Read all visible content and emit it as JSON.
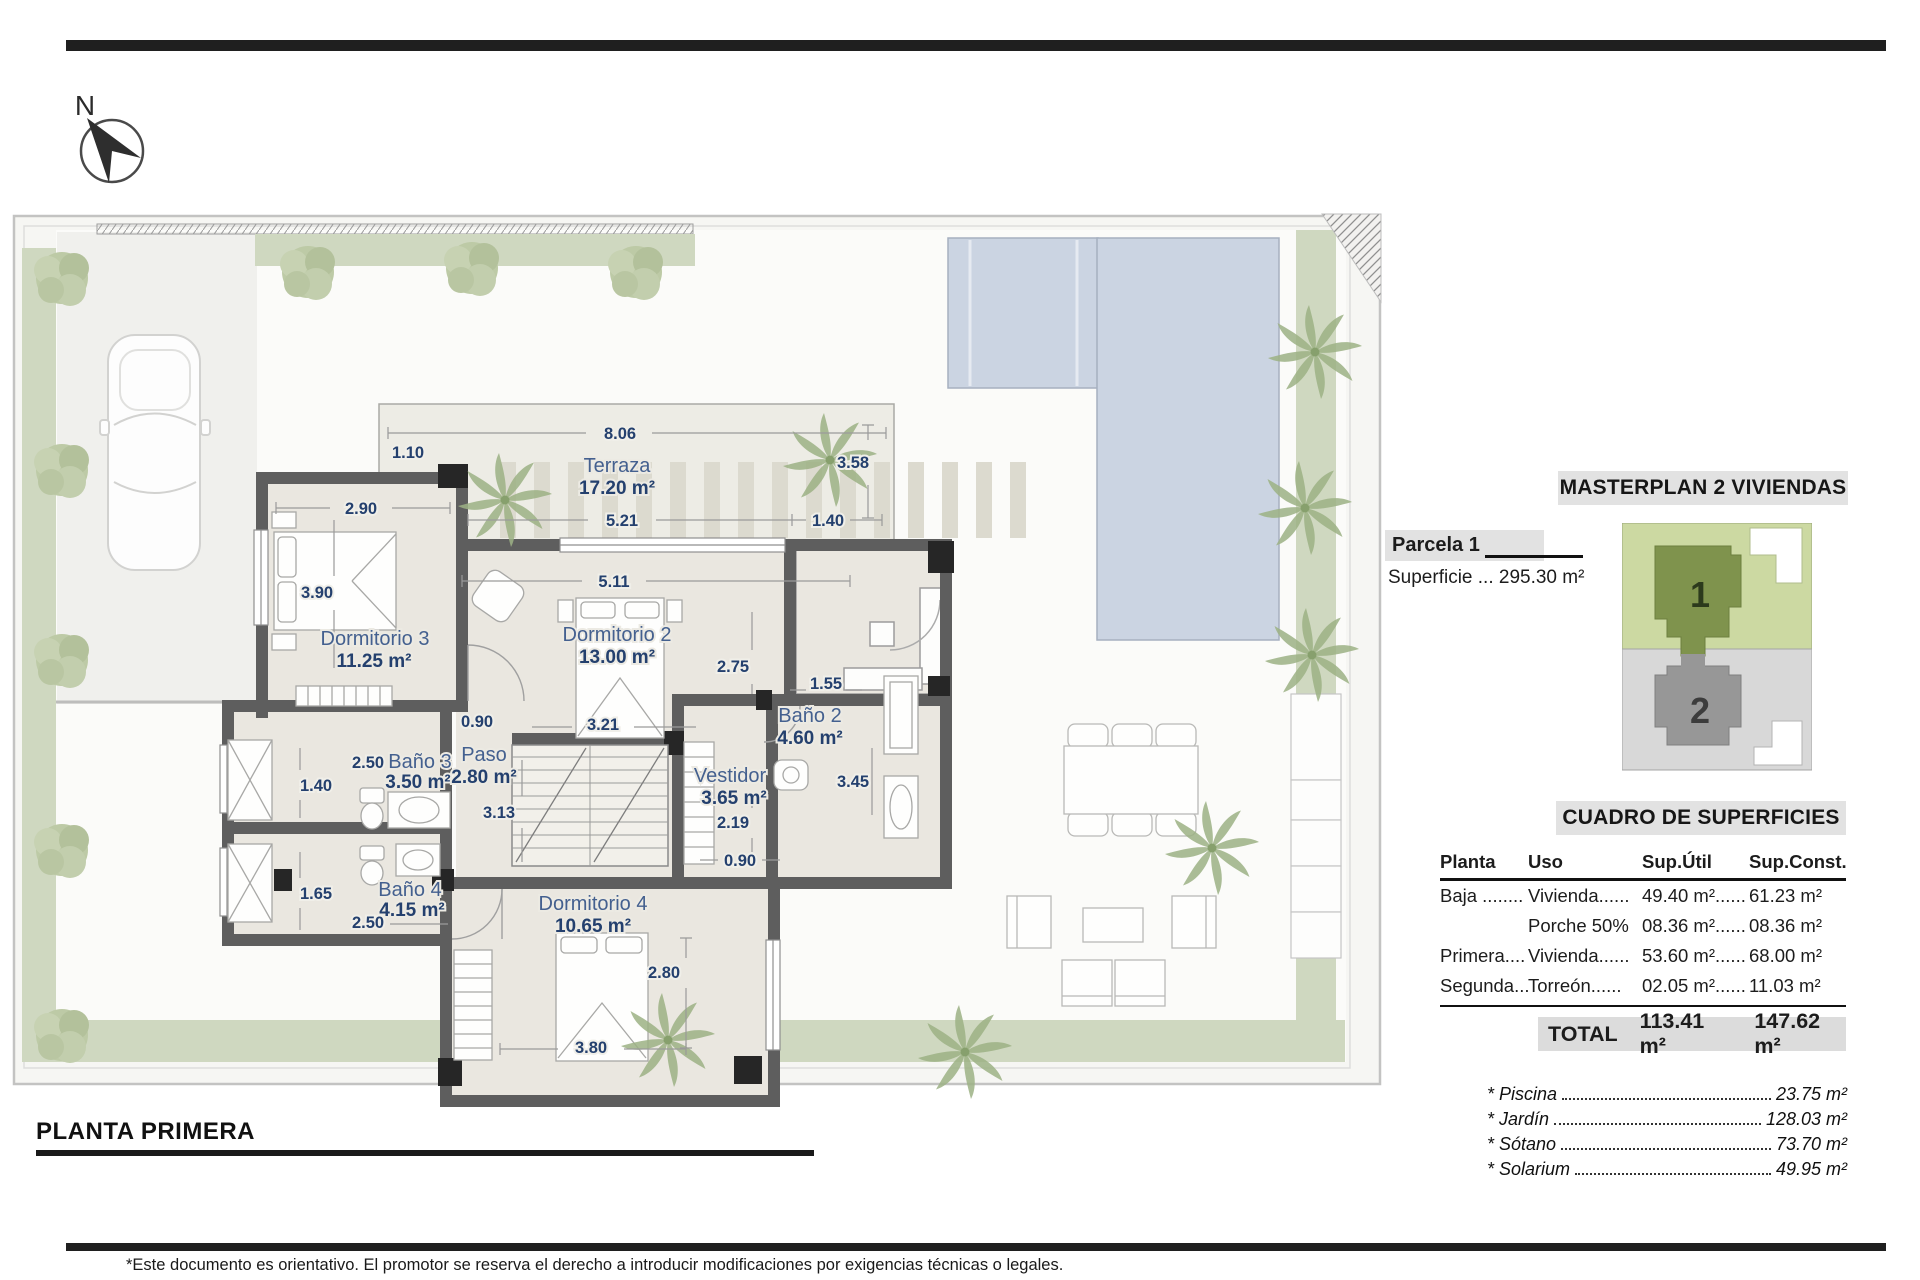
{
  "page": {
    "north_label": "N",
    "plan_title": "PLANTA PRIMERA",
    "disclaimer": "*Este documento es orientativo. El promotor se reserva el derecho a introducir modificaciones por exigencias técnicas o legales."
  },
  "plan": {
    "rooms": {
      "terraza": {
        "name": "Terraza",
        "area": "17.20 m²"
      },
      "dormitorio3": {
        "name": "Dormitorio 3",
        "area": "11.25 m²"
      },
      "dormitorio2": {
        "name": "Dormitorio 2",
        "area": "13.00 m²"
      },
      "bano2": {
        "name": "Baño 2",
        "area": "4.60 m²"
      },
      "bano3": {
        "name": "Baño 3",
        "area": "3.50 m²"
      },
      "bano4": {
        "name": "Baño 4",
        "area": "4.15 m²"
      },
      "paso": {
        "name": "Paso",
        "area": "2.80 m²"
      },
      "vestidor": {
        "name": "Vestidor",
        "area": "3.65 m²"
      },
      "dormitorio4": {
        "name": "Dormitorio 4",
        "area": "10.65 m²"
      }
    },
    "dims": {
      "terraza_width": "8.06",
      "terraza_left": "1.10",
      "terraza_right": "3.58",
      "dorm3_width": "2.90",
      "terraza_inner": "5.21",
      "terraza_gap": "1.40",
      "dorm2_width": "5.11",
      "dorm3_height": "3.90",
      "dorm2_height": "2.75",
      "bano2_width": "1.55",
      "paso_width": "0.90",
      "bed2_width": "3.21",
      "paso_height": "3.13",
      "vestidor_height": "2.19",
      "vestidor_width": "0.90",
      "bano2_height": "3.45",
      "bano3_width": "2.50",
      "bano3_height": "1.40",
      "bano4_height": "1.65",
      "bano4_width": "2.50",
      "dorm4_height": "2.80",
      "dorm4_width": "3.80"
    }
  },
  "masterplan": {
    "title": "MASTERPLAN 2 VIVIENDAS",
    "parcela": "Parcela 1",
    "superficie": "Superficie ... 295.30 m²",
    "unit1": "1",
    "unit2": "2"
  },
  "cuadro": {
    "title": "CUADRO DE SUPERFICIES",
    "headers": {
      "planta": "Planta",
      "uso": "Uso",
      "util": "Sup.Útil",
      "const": "Sup.Const."
    },
    "rows": [
      {
        "planta": "Baja ........",
        "uso": "Vivienda......",
        "util": "49.40 m²......",
        "const": "61.23 m²"
      },
      {
        "planta": "",
        "uso": "Porche 50%",
        "util": "08.36 m²......",
        "const": "08.36 m²"
      },
      {
        "planta": "Primera....",
        "uso": "Vivienda......",
        "util": "53.60 m²......",
        "const": "68.00 m²"
      },
      {
        "planta": "Segunda...",
        "uso": "Torreón......",
        "util": "02.05 m²......",
        "const": "11.03 m²"
      }
    ],
    "total": {
      "label": "TOTAL",
      "util": "113.41 m²",
      "const": "147.62 m²"
    },
    "extras": [
      {
        "label": "* Piscina",
        "value": "23.75 m²"
      },
      {
        "label": "* Jardín",
        "value": "128.03 m²"
      },
      {
        "label": "* Sótano",
        "value": "73.70 m²"
      },
      {
        "label": "* Solarium",
        "value": "49.95 m²"
      }
    ]
  }
}
